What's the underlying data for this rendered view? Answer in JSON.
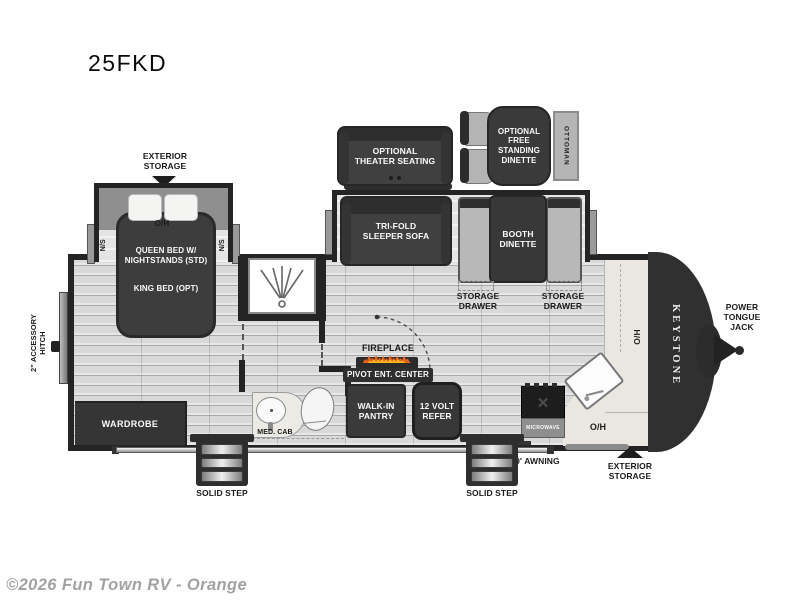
{
  "page": {
    "title": "25FKD",
    "copyright": "©2026 Fun Town RV - Orange"
  },
  "colors": {
    "wall": "#242424",
    "furniture_dark": "#3d3d3d",
    "floor_light": "#d9d9d9",
    "slide_floor": "#e4e4e4",
    "bench_gray": "#b8b8b8",
    "counter_beige": "#eae7e1",
    "flame_orange": "#e8611c",
    "flame_yellow": "#fcb51e",
    "copyright_gray": "#a2a2a2"
  },
  "exterior": {
    "storage_rear_label": "EXTERIOR\nSTORAGE",
    "storage_front_label": "EXTERIOR\nSTORAGE",
    "power_tongue_jack_label": "POWER\nTONGUE\nJACK",
    "accessory_hitch_label": "2\" ACCESSORY\nHITCH",
    "awning_label": "20' AWNING",
    "solid_step_rear_label": "SOLID STEP",
    "solid_step_front_label": "SOLID STEP",
    "brand_label": "KEYSTONE"
  },
  "optional_furniture": {
    "theater_seating_label": "OPTIONAL\nTHEATER SEATING",
    "free_standing_dinette_label": "OPTIONAL\nFREE\nSTANDING\nDINETTE",
    "ottoman_label": "OTTOMAN"
  },
  "bedroom": {
    "overhead_label": "O/H",
    "nightstand_left_label": "N/S",
    "nightstand_right_label": "N/S",
    "bed_label": "QUEEN BED W/\nNIGHTSTANDS (STD)",
    "bed_option_label": "KING BED (OPT)",
    "wardrobe_label": "WARDROBE"
  },
  "bathroom": {
    "med_cab_label": "MED. CAB"
  },
  "living_area": {
    "sofa_label": "TRI-FOLD\nSLEEPER SOFA",
    "booth_dinette_label": "BOOTH\nDINETTE",
    "storage_drawer_left_label": "STORAGE\nDRAWER",
    "storage_drawer_right_label": "STORAGE\nDRAWER",
    "fireplace_label": "FIREPLACE",
    "pivot_ent_center_label": "PIVOT ENT. CENTER",
    "walk_in_pantry_label": "WALK-IN\nPANTRY",
    "refer_label": "12 VOLT\nREFER"
  },
  "kitchen": {
    "microwave_label": "MICROWAVE",
    "overhead_counter_label": "O/H",
    "overhead_front_label": "O/H"
  }
}
